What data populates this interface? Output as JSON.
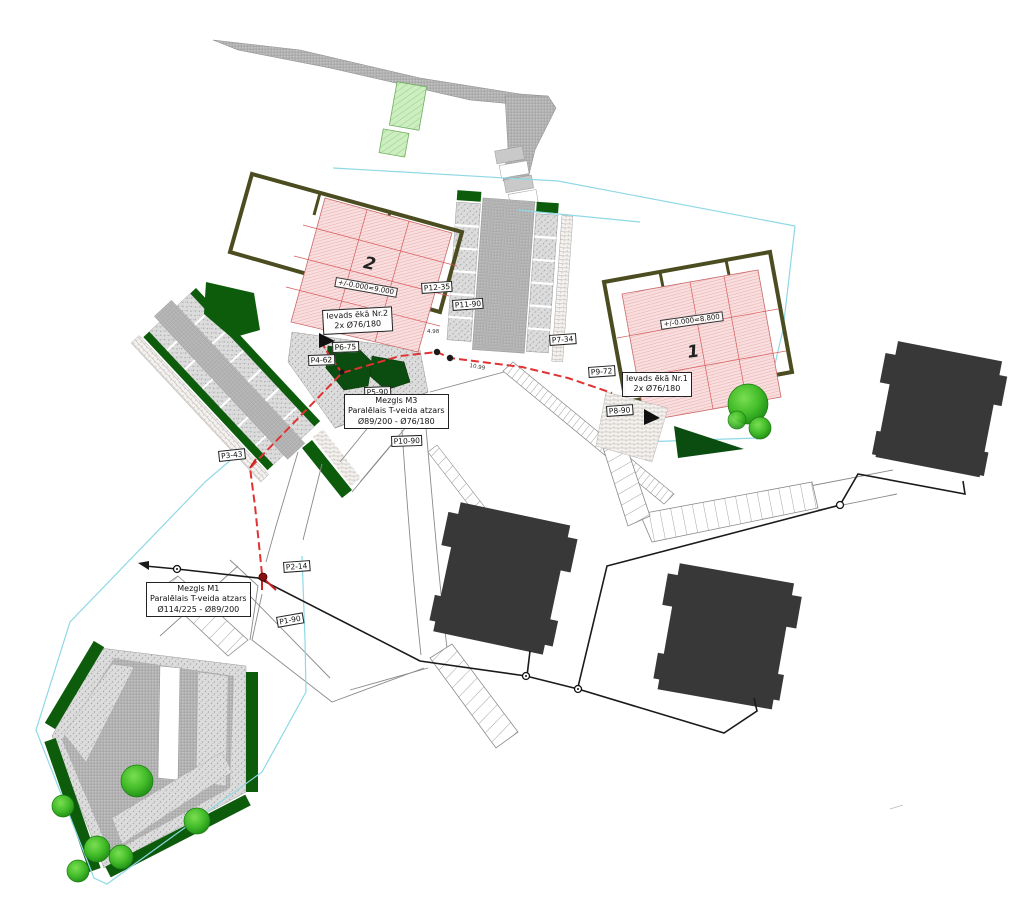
{
  "buildings": {
    "b2": {
      "number": "2",
      "elevation": "+/-0.000=9.000",
      "entry": {
        "line1": "Ievads ēkā Nr.2",
        "line2": "2x Ø76/180"
      }
    },
    "b1": {
      "number": "1",
      "elevation": "+/-0.000=8.800",
      "entry": {
        "line1": "Ievads ēkā Nr.1",
        "line2": "2x Ø76/180"
      }
    }
  },
  "nodes": {
    "m3": {
      "title": "Mezgls M3",
      "desc": "Paralēlais T-veida atzars",
      "size": "Ø89/200 - Ø76/180"
    },
    "m1": {
      "title": "Mezgls M1",
      "desc": "Paralēlais T-veida atzars",
      "size": "Ø114/225 - Ø89/200"
    }
  },
  "markers": {
    "p1": "P1-90",
    "p2": "P2-14",
    "p3": "P3-43",
    "p4": "P4-62",
    "p5": "P5-90",
    "p6": "P6-75",
    "p7": "P7-34",
    "p8": "P8-90",
    "p9": "P9-72",
    "p10": "P10-90",
    "p11": "P11-90",
    "p12": "P12-35"
  },
  "dimensions": {
    "d1": "4.98",
    "d2": "10.99"
  },
  "colors": {
    "proposed_heating": "#e03232",
    "existing_utility": "#1a1a1a",
    "boundary": "#8fd8e6",
    "building_fill": "#f8dede",
    "building_grid": "#d95b5b",
    "walls": "#4c4c21",
    "landscape_dark": "#0c5c0c",
    "tree_bright": "#44bd2a",
    "existing_building": "#383838",
    "paving": "#c2c2c2"
  }
}
